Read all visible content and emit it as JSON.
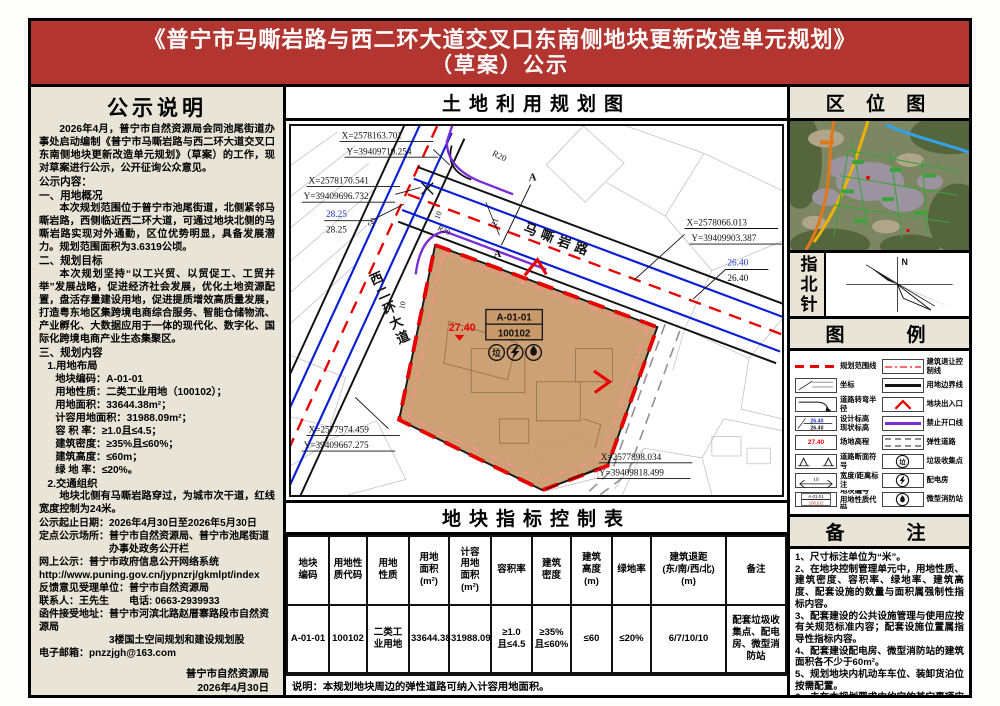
{
  "header": {
    "title_line1": "《普宁市马嘶岩路与西二环大道交叉口东南侧地块更新改造单元规划》",
    "title_line2": "（草案）公示"
  },
  "notice": {
    "title": "公示说明",
    "intro": "2026年4月，普宁市自然资源局会同池尾街道办事处启动编制《普宁市马嘶岩路与西二环大道交叉口东南侧地块更新改造单元规划》（草案）的工作，现对草案进行公示，公开征询公众意见。",
    "content_label": "公示内容：",
    "s1_title": "一、用地概况",
    "s1_text": "本次规划范围位于普宁市池尾街道，北侧紧邻马嘶岩路，西侧临近西二环大道，可通过地块北侧的马嘶岩路实现对外通勤，区位优势明显，具备发展潜力。规划范围面积为3.6319公顷。",
    "s2_title": "二、规划目标",
    "s2_text": "本次规划坚持“以工兴贸、以贸促工、工贸并举”发展战略，促进经济社会发展，优化土地资源配置，盘活存量建设用地，促进提质增效高质量发展，打造粤东地区集跨境电商综合服务、智能仓储物流、产业孵化、大数据应用于一体的现代化、数字化、国际化跨境电商产业生态集聚区。",
    "s3_title": "三、规划内容",
    "s3_1_title": "1.用地布局",
    "plot_lines": [
      "地块编码：A-01-01",
      "用地性质：二类工业用地（100102）；",
      "用地面积：33644.38m²；",
      "计容用地面积：31988.09m²；",
      "容 积 率：≥1.0且≤4.5；",
      "建筑密度：≥35%且≤60%；",
      "建筑高度：≤60m；",
      "绿 地 率：≤20%。"
    ],
    "s3_2_title": "2.交通组织",
    "s3_2_text": "地块北侧有马嘶岩路穿过，为城市次干道，红线宽度控制为24米。",
    "footer_lines": [
      "公示起止日期：2026年4月30日至2026年5月30日",
      "定点公示场所：普宁市自然资源局、普宁市池尾街道\n　　　　　　　办事处政务公开栏",
      "网上公示：普宁市政府信息公开网络系统",
      "http://www.puning.gov.cn/jypnzrj/gkmlpt/index",
      "反馈意见受理单位：普宁市自然资源局",
      "联系人：王先生　　电话: 0663-2939933",
      "函件接受地址：普宁市河滨北路赵厝寨路段市自然资源局\n　　　　　　　3楼国土空间规划和建设规划股",
      "电子邮箱：pnzzjgh@163.com"
    ],
    "signature1": "普宁市自然资源局",
    "signature2": "2026年4月30日"
  },
  "map": {
    "title": "土地利用规划图",
    "road_mxy": "马嘶岩路",
    "road_xeh": "西二环大道",
    "parcel_code": "A-01-01",
    "parcel_use": "100102",
    "site_elev": "27.40",
    "c1x": "X=2578163.701",
    "c1y": "Y=39409710.254",
    "c2x": "X=2578170.541",
    "c2y": "Y=39409696.732",
    "c3x": "X=2578066.013",
    "c3y": "Y=39409903.387",
    "c4x": "X=2577974.459",
    "c4y": "Y=39409667.275",
    "c5x": "X=2577898.034",
    "c5y": "Y=39409818.499",
    "e1a": "28.25",
    "e1b": "28.25",
    "e2a": "26.40",
    "e2b": "26.40",
    "r20": "R20",
    "w50": "50",
    "w21": "21",
    "w10": "10",
    "sec_a": "A",
    "trash_glyph": "垃"
  },
  "location": {
    "title": "区 位 图"
  },
  "compass": {
    "title": "指北针",
    "north": "N"
  },
  "legend": {
    "title": "图　　例",
    "elev_design": "26.40",
    "elev_exist": "26.40",
    "site_elev": "27.40",
    "dim_label": "10",
    "code1": "A-01-01",
    "code2": "100102",
    "trash_glyph": "垃",
    "left": [
      {
        "label": "规划范围线"
      },
      {
        "label": "坐标"
      },
      {
        "label": "道路转弯半径"
      },
      {
        "label": "设计标高\n现状标高"
      },
      {
        "label": "场地高程"
      },
      {
        "label": "道路断面符号"
      },
      {
        "label": "宽度/距离标注"
      },
      {
        "label": "地块编号\n用地性质代码"
      }
    ],
    "right": [
      {
        "label": "建筑退让控制线"
      },
      {
        "label": "用地边界线"
      },
      {
        "label": "地块出入口"
      },
      {
        "label": "禁止开口线"
      },
      {
        "label": "弹性道路"
      },
      {
        "label": "垃圾收集点"
      },
      {
        "label": "配电房"
      },
      {
        "label": "微型消防站"
      }
    ]
  },
  "table": {
    "title": "地块指标控制表",
    "headers": [
      "地块\n编码",
      "用地性\n质代码",
      "用地\n性质",
      "用地\n面积\n(m²)",
      "计容\n用地\n面积\n(m²)",
      "容积率",
      "建筑\n密度",
      "建筑\n高度\n(m)",
      "绿地率",
      "建筑退距\n(东/南/西/北)\n(m)",
      "备注"
    ],
    "row": [
      "A-01-01",
      "100102",
      "二类工\n业用地",
      "33644.38",
      "31988.09",
      "≥1.0\n且≤4.5",
      "≥35%\n且≤60%",
      "≤60",
      "≤20%",
      "6/7/10/10",
      "配套垃圾收集点、配电房、微型消防站"
    ],
    "note": "说明：本规划地块周边的弹性道路可纳入计容用地面积。"
  },
  "remarks": {
    "title": "备　　注",
    "items": [
      "1、尺寸标注单位为“米”。",
      "2、在地块控制管理单元中，用地性质、建筑密度、容积率、绿地率、建筑高度、配套设施的数量与面积属强制性指标内容。",
      "3、配套建设的公共设施管理与使用应按有关规范标准内容；配套设施位置属指导性指标内容。",
      "4、配套建设配电房、微型消防站的建筑面积各不少于60m²。",
      "5、规划地块内机动车车位、装卸货泊位按需配置。",
      "6、未在本规划要求中约定的其它事项应遵从国家、省、市有关政策和标准。"
    ]
  }
}
